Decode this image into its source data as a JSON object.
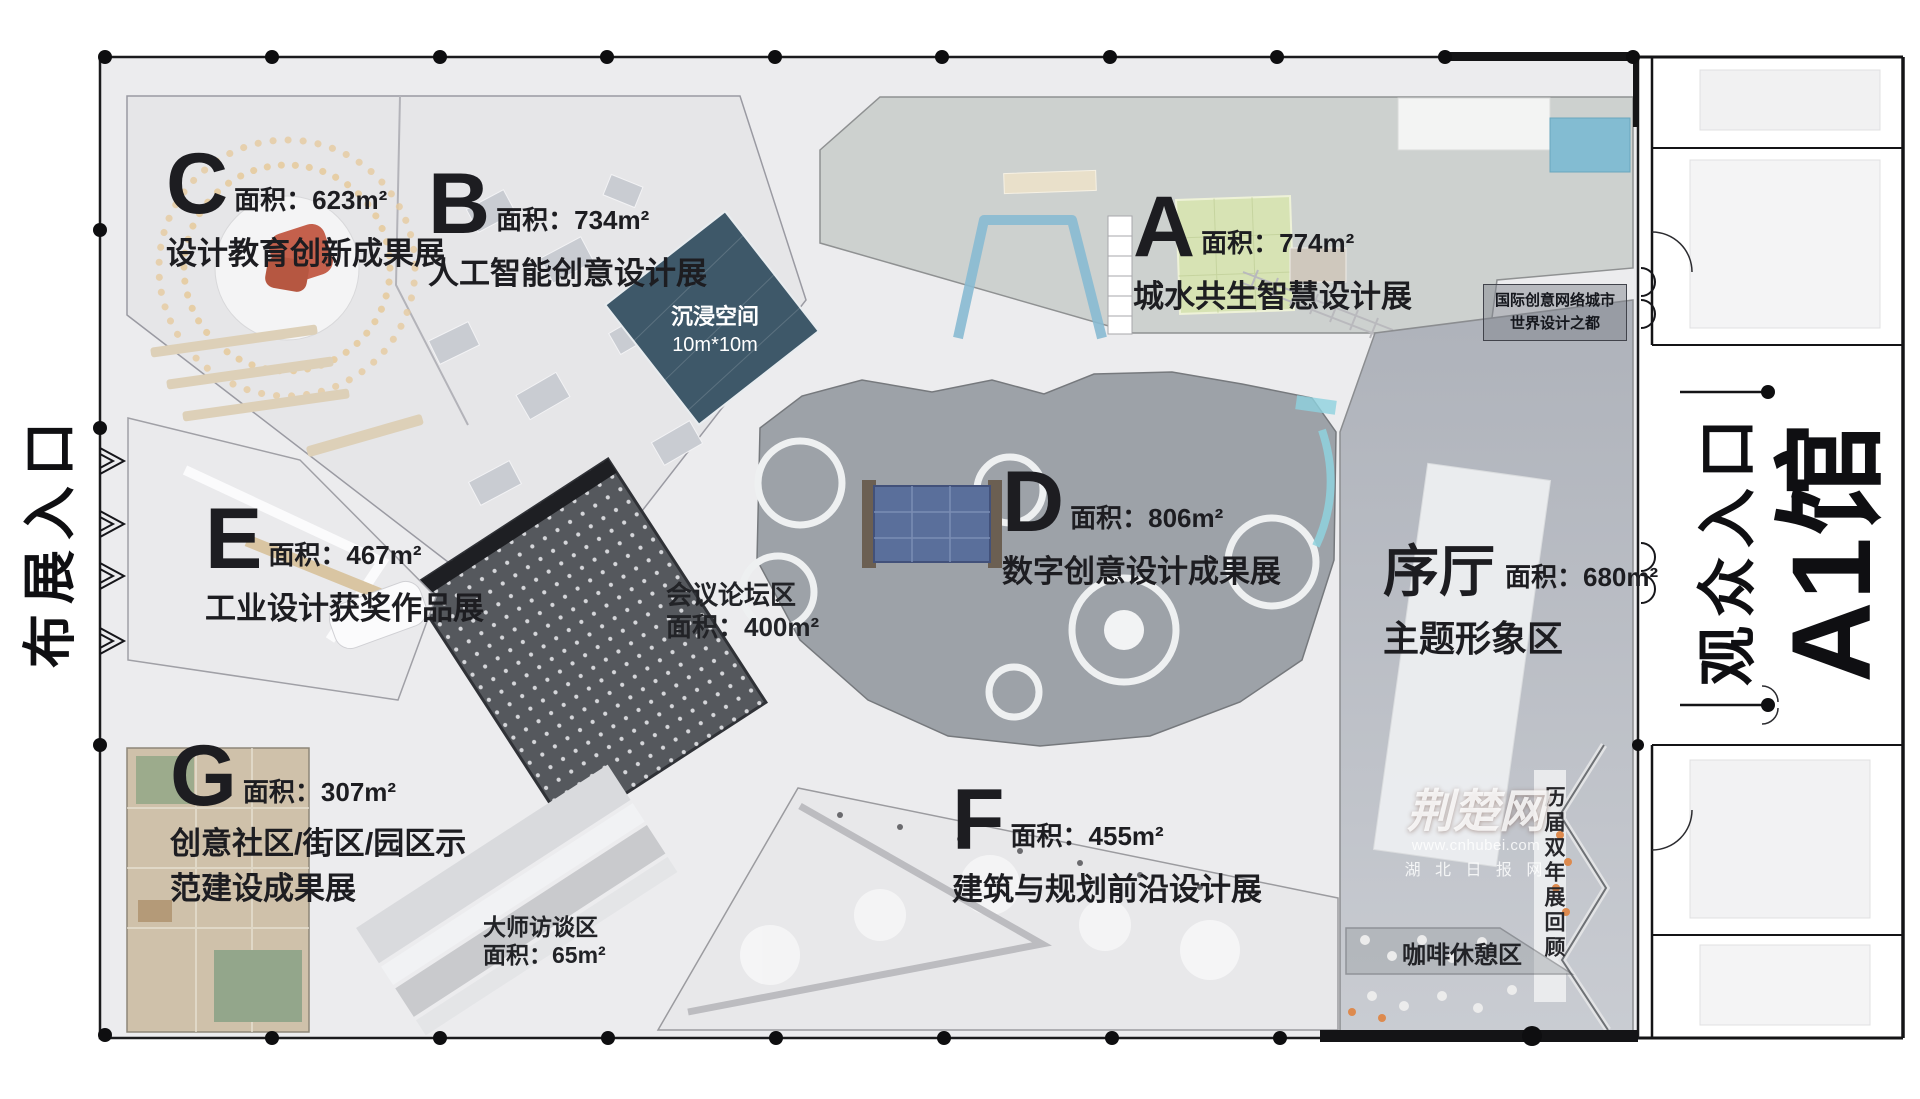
{
  "entrances": {
    "setup": "布展入口",
    "visitor": "观众入口",
    "hall": "A1馆"
  },
  "zones": {
    "a": {
      "letter": "A",
      "area": "面积：774m²",
      "name": "城水共生智慧设计展"
    },
    "b": {
      "letter": "B",
      "area": "面积：734m²",
      "name": "人工智能创意设计展"
    },
    "c": {
      "letter": "C",
      "area": "面积：623m²",
      "name": "设计教育创新成果展"
    },
    "d": {
      "letter": "D",
      "area": "面积：806m²",
      "name": "数字创意设计成果展"
    },
    "e": {
      "letter": "E",
      "area": "面积：467m²",
      "name": "工业设计获奖作品展"
    },
    "f": {
      "letter": "F",
      "area": "面积：455m²",
      "name": "建筑与规划前沿设计展"
    },
    "g": {
      "letter": "G",
      "area": "面积：307m²",
      "name_line1": "创意社区/街区/园区示",
      "name_line2": "范建设成果展"
    }
  },
  "foyer": {
    "title": "序厅",
    "area": "面积：680m²",
    "name": "主题形象区"
  },
  "areas": {
    "immersive_line1": "沉浸空间",
    "immersive_line2": "10m*10m",
    "conference_line1": "会议论坛区",
    "conference_line2": "面积：400m²",
    "master_line1": "大师访谈区",
    "master_line2": "面积：65m²",
    "biennale": "历届双年展回顾",
    "coffee": "咖啡休憩区",
    "badge_line1": "国际创意网络城市",
    "badge_line2": "世界设计之都"
  },
  "watermark": {
    "logo": "荆楚网",
    "url": "www.cnhubei.com",
    "publisher": "湖 北 日 报 网"
  },
  "colors": {
    "immersive": "#3e5869",
    "conference_roof": "#55585d",
    "zone_d": "#9da2a8",
    "foyer_top": "#aeb2ba",
    "wood": "#cfc1aa",
    "lawn_green": "#d7e3b4",
    "water_blue": "#88bad1",
    "stage_red": "#c4604c",
    "wall_black": "#141416"
  }
}
